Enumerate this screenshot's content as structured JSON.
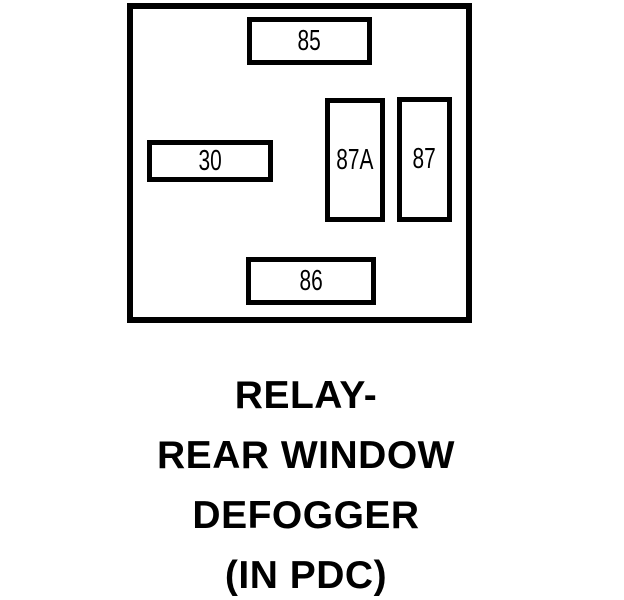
{
  "diagram": {
    "type": "relay-pinout",
    "colors": {
      "line": "#000000",
      "background": "#ffffff"
    },
    "pins": [
      {
        "label": "85"
      },
      {
        "label": "30"
      },
      {
        "label": "87A"
      },
      {
        "label": "87"
      },
      {
        "label": "86"
      }
    ],
    "caption": {
      "lines": [
        "RELAY-",
        "REAR WINDOW",
        "DEFOGGER",
        "(IN PDC)"
      ]
    }
  }
}
